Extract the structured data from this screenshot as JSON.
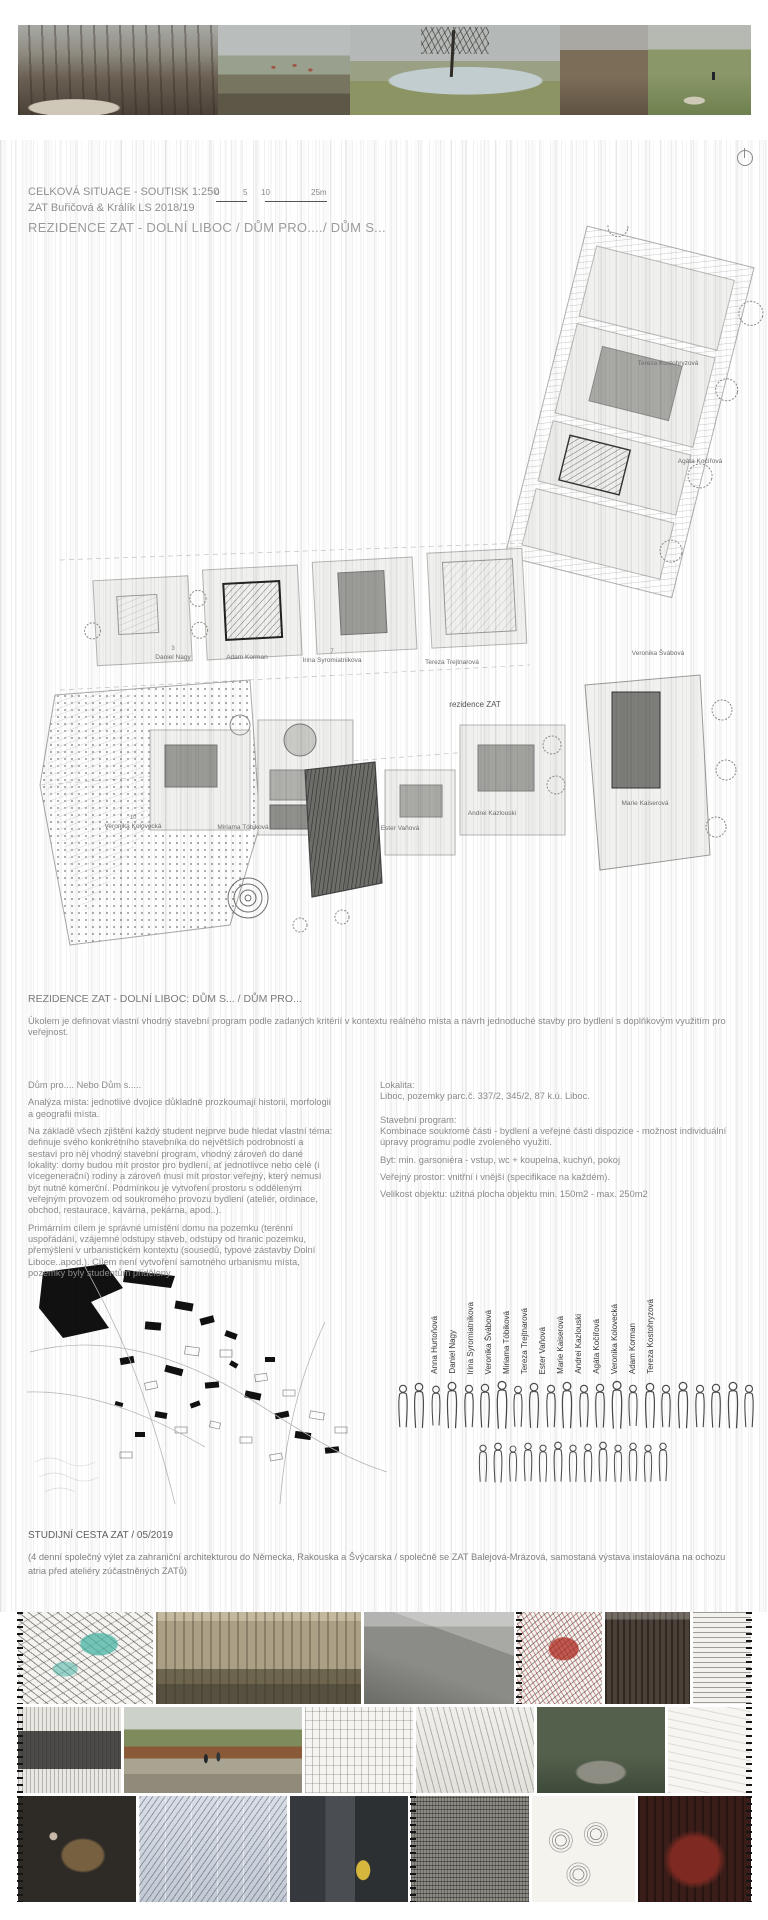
{
  "colors": {
    "stripe": "#d9d9d9",
    "text_grey": "#8a8a8a",
    "title_grey": "#9b9b9b",
    "teal_accent": "#49b3a4",
    "red_accent": "#b23a2e",
    "corten": "#8a5a38",
    "yellow_accent": "#d6b63c"
  },
  "header": {
    "line1": "CELKOVÁ SITUACE - SOUTISK 1:250",
    "line2": "ZAT Buřičová & Králík LS 2018/19",
    "line3": "REZIDENCE ZAT - DOLNÍ LIBOC / DŮM PRO..../ DŮM S..."
  },
  "scalebar": {
    "l0": "0",
    "l1": "5",
    "l2": "10",
    "l3": "25m"
  },
  "siteplan": {
    "rezidence_label": "rezidence ZAT",
    "plots": [
      {
        "num": "3",
        "name": "Daniel Nagy"
      },
      {
        "num": "",
        "name": "Adam Korman"
      },
      {
        "num": "7",
        "name": "Irina Syromiatnikova"
      },
      {
        "num": "",
        "name": "Tereza Trejtnarová"
      },
      {
        "num": "",
        "name": "Tereza Kostohryzová"
      },
      {
        "num": "",
        "name": "Agáta Kočířová"
      },
      {
        "num": "",
        "name": "Veronika Švábová"
      },
      {
        "num": "",
        "name": "Marie Kaiserová"
      },
      {
        "num": "10",
        "name": "Veronika Kolovecká"
      },
      {
        "num": "",
        "name": "Miriama Tóbiková"
      },
      {
        "num": "",
        "name": "Ester Vaňová"
      },
      {
        "num": "",
        "name": "Andrei Kazlouski"
      }
    ]
  },
  "description": {
    "title": "REZIDENCE ZAT - DOLNÍ LIBOC: DŮM S... / DŮM PRO...",
    "intro": "Úkolem je definovat vlastní vhodný stavební program podle zadaných kritérií v kontextu reálného místa a návrh jednoduché stavby pro bydlení s doplňkovým využitím pro veřejnost.",
    "left_paragraphs": [
      "Dům pro.... Nebo Dům s.....",
      "Analýza místa: jednotlivé dvojice důkladně prozkoumají historii, morfologii a geografii místa.",
      "Na základě všech zjištění každý student nejprve bude hledat vlastní téma: definuje svého konkrétního stavebníka do největších podrobností a sestaví pro něj vhodný stavební program, vhodný zároveň do dané lokality: domy budou mít prostor pro bydlení, ať jednotlivce nebo celé (i vícegenerační) rodiny a zároveň musí mít prostor veřejný, který nemusí být nutně komerční. Podmínkou je vytvoření prostoru s odděleným veřejným provozem od soukromého provozu bydlení (ateliér, ordinace, obchod, restaurace, kavárna, pekárna, apod..).",
      "Primárním cílem je správné umístění domu na pozemku (terénní uspořádání, vzájemné odstupy staveb, odstupy od hranic pozemku, přemýšlení v urbanistickém kontextu (sousedů, typové zástavby Dolní Liboce..apod.). Cílem není vytvoření samotného urbanismu místa, pozemky byly studentům přiděleny."
    ],
    "right": {
      "lokalita_label": "Lokalita:",
      "lokalita_text": "Liboc, pozemky parc.č. 337/2, 345/2, 87 k.ú. Liboc.",
      "program_label": "Stavební program:",
      "program_lines": [
        "Kombinace soukromé části - bydlení a veřejné části dispozice - možnost individuální úpravy programu podle zvoleného využití.",
        "Byt: min. garsoniéra - vstup, wc + koupelna, kuchyň, pokoj",
        "Veřejný prostor: vnitřní i vnější (specifikace na každém).",
        "Velikost objektu: užitná plocha objektu min. 150m2 - max. 250m2"
      ]
    }
  },
  "students": [
    "Anna Hurtoňová",
    "Daniel Nagy",
    "Irina Syromiatnikova",
    "Veronika Švábová",
    "Miriama Tóbiková",
    "Tereza Trejtnarová",
    "Ester Vaňová",
    "Marie Kaiserová",
    "Andrei Kazlouski",
    "Agáta Kočířová",
    "Veronika Kolovecká",
    "Adam Korman",
    "Tereza Kostohryzová"
  ],
  "trip": {
    "title": "STUDIJNÍ CESTA ZAT / 05/2019",
    "text": "(4 denní společný výlet za zahraniční architekturou do Německa, Rakouska a Švýcarska / společně se ZAT Balejová-Mrázová, samostaná výstava instalována na ochozu atria před ateliéry zúčastněných ZATů)"
  },
  "top_photos": [
    {
      "name": "photo-trees-stone-wall"
    },
    {
      "name": "photo-village-view"
    },
    {
      "name": "photo-pond-bare-tree"
    },
    {
      "name": "photo-muddy-field"
    },
    {
      "name": "photo-meadow-path-walker"
    }
  ],
  "collage": {
    "row1": [
      "sketch-teal-architecture",
      "photo-concrete-building-group",
      "photo-concrete-interior",
      "sketch-red-scribble",
      "photo-timber-facade",
      "sketch-horizontal-lines"
    ],
    "row2": [
      "sketch-dark-building",
      "photo-gravel-path-people",
      "sketch-pavilion-lines",
      "sketch-interior-perspective",
      "photo-river-group",
      "sketch-white-minimal"
    ],
    "row3": [
      "photo-workshop-overhead",
      "sketch-blue-pages",
      "photo-street-yellow-object",
      "sketch-dark-pages",
      "sketch-three-circles",
      "photo-red-interior"
    ]
  }
}
